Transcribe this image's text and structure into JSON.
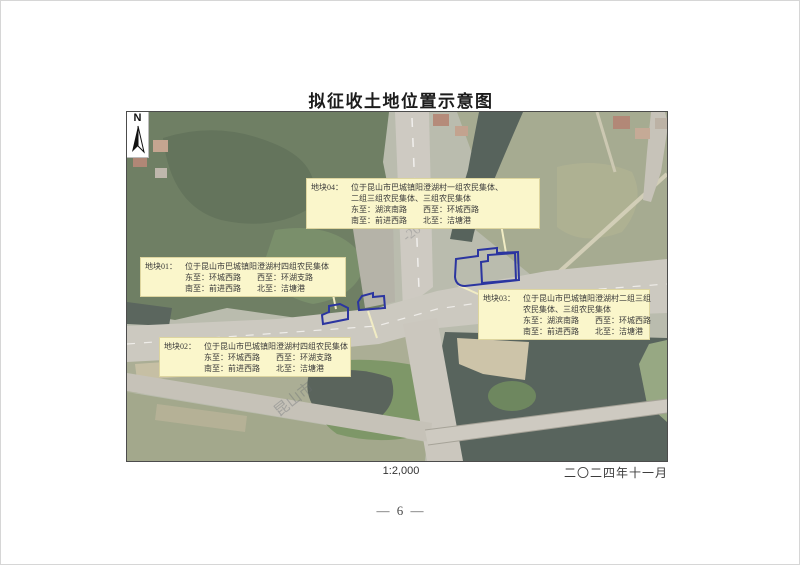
{
  "page": {
    "title": "拟征收土地位置示意图",
    "scale_label": "1:2,000",
    "date_label": "二〇二四年十一月",
    "page_number": "— 6 —"
  },
  "map": {
    "type": "satellite-location-map",
    "north_label": "N",
    "parcel_outline_color": "#2b35a0",
    "annotation_bg": "#faf6cb",
    "watermark_fragments": [
      "昆山市",
      "-20"
    ],
    "annotations": [
      {
        "id": "地块01：",
        "lines": [
          "位于昆山市巴城镇阳澄湖村四组农民集体",
          "东至：环城西路　　西至：环湖支路",
          "南至：前进西路　　北至：洁塘港"
        ]
      },
      {
        "id": "地块02：",
        "lines": [
          "位于昆山市巴城镇阳澄湖村四组农民集体",
          "东至：环城西路　　西至：环湖支路",
          "南至：前进西路　　北至：洁塘港"
        ]
      },
      {
        "id": "地块03：",
        "lines": [
          "位于昆山市巴城镇阳澄湖村二组三组",
          "农民集体、三组农民集体",
          "东至：湖滨南路　　西至：环城西路",
          "南至：前进西路　　北至：洁塘港"
        ]
      },
      {
        "id": "地块04：",
        "lines": [
          "位于昆山市巴城镇阳澄湖村一组农民集体、",
          "二组三组农民集体、三组农民集体",
          "东至：湖滨南路　　西至：环城西路",
          "南至：前进西路　　北至：洁塘港"
        ]
      }
    ]
  }
}
